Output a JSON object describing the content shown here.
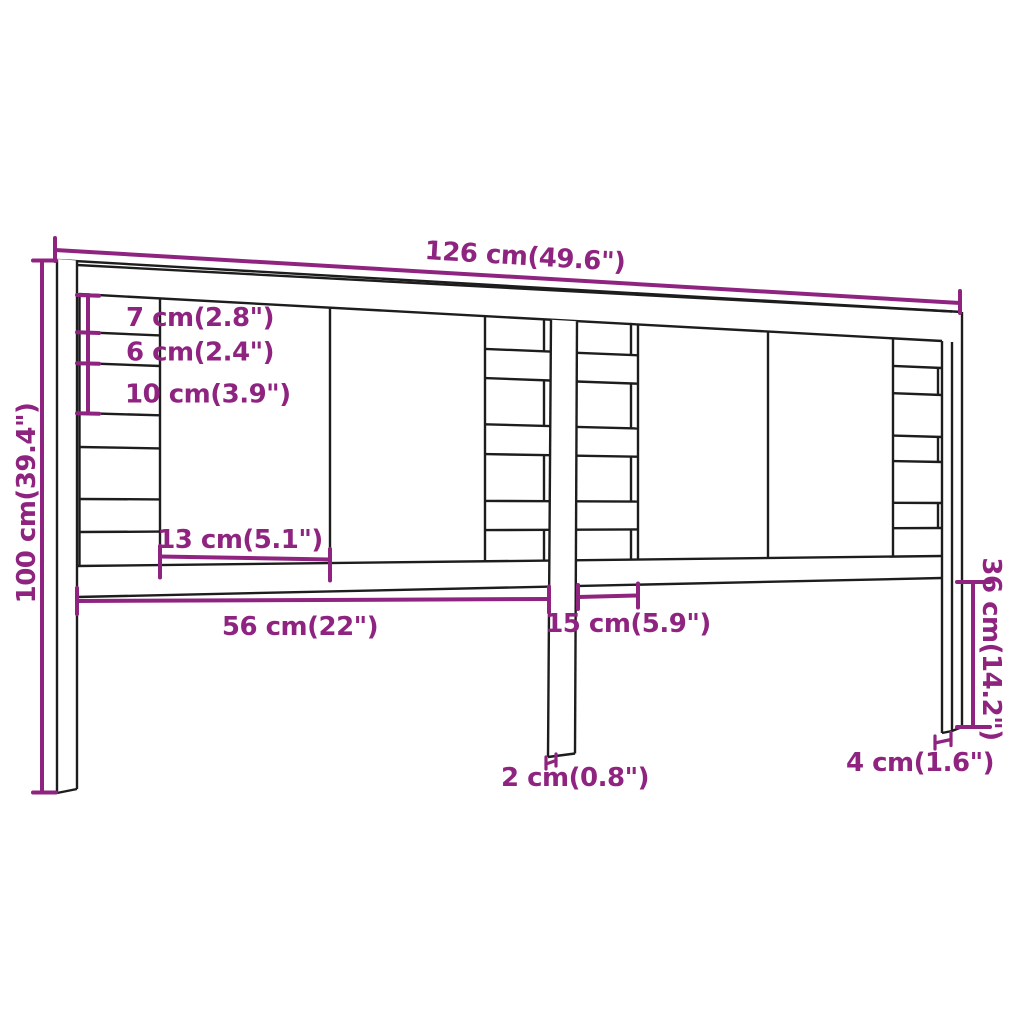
{
  "diagram": {
    "kind": "furniture-dimension-drawing",
    "colors": {
      "background": "#ffffff",
      "outline": "#1d1d1d",
      "dimension": "#8F2480"
    },
    "dimensions": {
      "overall_width": "126 cm(49.6\")",
      "overall_height": "100 cm(39.4\")",
      "top_slat_height": "7 cm(2.8\")",
      "slat_gap": "6 cm(2.4\")",
      "slat_height": "10 cm(3.9\")",
      "board_width": "13 cm(5.1\")",
      "left_section_width": "56 cm(22\")",
      "center_section_width": "15 cm(5.9\")",
      "leg_free_height": "36 cm(14.2\")",
      "center_post_thickness": "2 cm(0.8\")",
      "leg_thickness": "4 cm(1.6\")"
    }
  }
}
